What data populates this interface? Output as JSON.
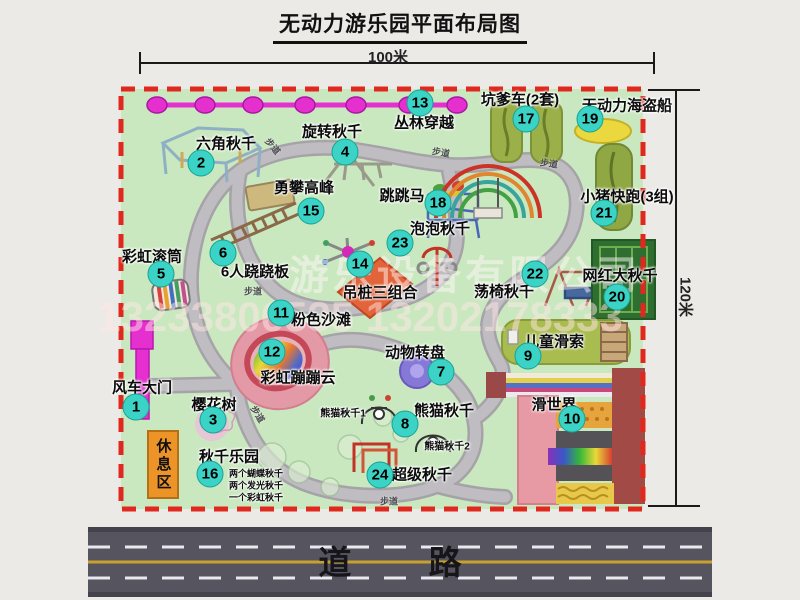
{
  "title": "无动力游乐园平面布局图",
  "dim_top": "100米",
  "dim_right": "120米",
  "road_label": "道 路",
  "rest_area_label": "休息区",
  "path_label_text": "步道",
  "watermark": {
    "company": "游乐设备有限公司",
    "phone": "13233806535 13202178333"
  },
  "colors": {
    "park_green": "#c9e8bf",
    "border_red": "#e0281e",
    "badge_teal": "#3bd3c6",
    "gate_magenta": "#e530cf",
    "path_gray": "#b9b7bb",
    "road_gray": "#56545f",
    "rest_orange": "#ec9428"
  },
  "attractions": [
    {
      "num": "1",
      "label": "风车大门",
      "icon": "windmill-gate",
      "badge": [
        136,
        407
      ],
      "pos": [
        142,
        387
      ]
    },
    {
      "num": "2",
      "label": "六角秋千",
      "icon": "hexagon-swing",
      "badge": [
        201,
        163
      ],
      "pos": [
        226,
        143
      ]
    },
    {
      "num": "3",
      "label": "樱花树",
      "icon": "cherry-tree",
      "badge": [
        213,
        420
      ],
      "pos": [
        214,
        404
      ]
    },
    {
      "num": "4",
      "label": "旋转秋千",
      "icon": "spin-swing",
      "badge": [
        345,
        152
      ],
      "pos": [
        332,
        131
      ]
    },
    {
      "num": "5",
      "label": "彩虹滚筒",
      "icon": "rainbow-roller",
      "badge": [
        161,
        274
      ],
      "pos": [
        152,
        256
      ]
    },
    {
      "num": "6",
      "label": "6人跷跷板",
      "icon": "seesaw",
      "badge": [
        223,
        253
      ],
      "pos": [
        255,
        271
      ]
    },
    {
      "num": "7",
      "label": "动物转盘",
      "icon": "animal-turntable",
      "badge": [
        441,
        372
      ],
      "pos": [
        415,
        352
      ]
    },
    {
      "num": "8",
      "label": "熊猫秋千",
      "icon": "panda-swing",
      "badge": [
        405,
        424
      ],
      "pos": [
        444,
        410
      ]
    },
    {
      "num": "9",
      "label": "儿童滑索",
      "icon": "kids-zipline",
      "badge": [
        528,
        356
      ],
      "pos": [
        554,
        341
      ]
    },
    {
      "num": "10",
      "label": "滑世界",
      "icon": "slide-world",
      "badge": [
        572,
        419
      ],
      "pos": [
        554,
        404
      ]
    },
    {
      "num": "11",
      "label": "粉色沙滩",
      "icon": "pink-beach",
      "badge": [
        281,
        313
      ],
      "pos": [
        321,
        319
      ]
    },
    {
      "num": "12",
      "label": "彩虹蹦蹦云",
      "icon": "rainbow-bounce-cloud",
      "badge": [
        272,
        352
      ],
      "pos": [
        298,
        377
      ]
    },
    {
      "num": "13",
      "label": "丛林穿越",
      "icon": "jungle-zipline",
      "badge": [
        420,
        103
      ],
      "pos": [
        424,
        122
      ]
    },
    {
      "num": "14",
      "label": "吊桩三组合",
      "icon": "hanging-posts",
      "badge": [
        360,
        264
      ],
      "pos": [
        380,
        292
      ]
    },
    {
      "num": "15",
      "label": "勇攀高峰",
      "icon": "climbing-ladder",
      "badge": [
        311,
        211
      ],
      "pos": [
        304,
        187
      ]
    },
    {
      "num": "16",
      "label": "秋千乐园",
      "icon": "swing-park",
      "badge": [
        210,
        474
      ],
      "pos": [
        229,
        456
      ]
    },
    {
      "num": "17",
      "label": "坑爹车(2套)",
      "icon": "pit-car-track",
      "badge": [
        526,
        119
      ],
      "pos": [
        520,
        99
      ]
    },
    {
      "num": "18",
      "label": "跳跳马",
      "icon": "jump-horse",
      "badge": [
        438,
        203
      ],
      "pos": [
        402,
        195
      ]
    },
    {
      "num": "19",
      "label": "无动力海盗船",
      "icon": "pirate-ship",
      "badge": [
        590,
        119
      ],
      "pos": [
        627,
        105
      ]
    },
    {
      "num": "20",
      "label": "网红大秋千",
      "icon": "net-swing",
      "badge": [
        617,
        297
      ],
      "pos": [
        620,
        275
      ]
    },
    {
      "num": "21",
      "label": "小猪快跑(3组)",
      "icon": "piggy-run-track",
      "badge": [
        604,
        213
      ],
      "pos": [
        627,
        196
      ]
    },
    {
      "num": "22",
      "label": "荡椅秋千",
      "icon": "swing-chair",
      "badge": [
        535,
        274
      ],
      "pos": [
        504,
        291
      ]
    },
    {
      "num": "23",
      "label": "泡泡秋千",
      "icon": "bubble-swing",
      "badge": [
        400,
        243
      ],
      "pos": [
        440,
        228
      ]
    },
    {
      "num": "24",
      "label": "超级秋千",
      "icon": "super-swing",
      "badge": [
        380,
        475
      ],
      "pos": [
        422,
        474
      ]
    }
  ],
  "sub_labels": [
    {
      "text": "熊猫秋千1",
      "pos": [
        343,
        412
      ],
      "size": 10
    },
    {
      "text": "熊猫秋千2",
      "pos": [
        447,
        445
      ],
      "size": 10
    },
    {
      "text": "两个蝴蝶秋千",
      "pos": [
        229,
        473
      ],
      "size": 9,
      "align": "left"
    },
    {
      "text": "两个发光秋千",
      "pos": [
        229,
        485
      ],
      "size": 9,
      "align": "left"
    },
    {
      "text": "一个彩虹秋千",
      "pos": [
        229,
        497
      ],
      "size": 9,
      "align": "left"
    }
  ],
  "path_labels": [
    {
      "pos": [
        273,
        146
      ],
      "rot": 50
    },
    {
      "pos": [
        441,
        152
      ],
      "rot": 10
    },
    {
      "pos": [
        549,
        163
      ],
      "rot": 8
    },
    {
      "pos": [
        253,
        291
      ],
      "rot": 0
    },
    {
      "pos": [
        258,
        414
      ],
      "rot": 58
    },
    {
      "pos": [
        389,
        501
      ],
      "rot": 0
    }
  ]
}
